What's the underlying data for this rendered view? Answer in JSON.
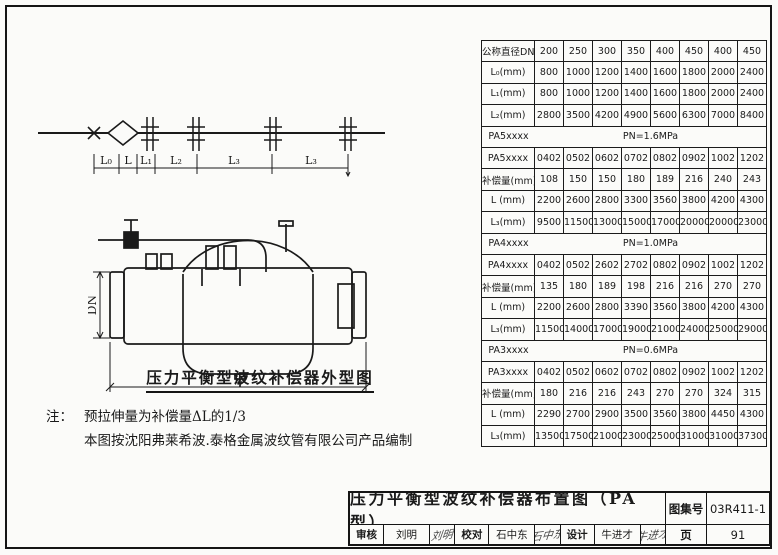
{
  "schematic": {
    "dimension_labels": [
      "L₀",
      "L",
      "L₁",
      "L₂",
      "L₃",
      "L₃"
    ]
  },
  "drawing": {
    "dn_label": "DN",
    "l_label": "L",
    "caption": "压力平衡型波纹补偿器外型图"
  },
  "notes": {
    "prefix": "注：",
    "line1": "预拉伸量为补偿量ΔL的1/3",
    "line2": "本图按沈阳弗莱希波.泰格金属波纹管有限公司产品编制"
  },
  "spec_table": {
    "rows": [
      {
        "label": "公称直径DN",
        "values": [
          "200",
          "250",
          "300",
          "350",
          "400",
          "450",
          "400",
          "450"
        ]
      },
      {
        "label": "L₀(mm)",
        "values": [
          "800",
          "1000",
          "1200",
          "1400",
          "1600",
          "1800",
          "2000",
          "2400"
        ]
      },
      {
        "label": "L₁(mm)",
        "values": [
          "800",
          "1000",
          "1200",
          "1400",
          "1600",
          "1800",
          "2000",
          "2400"
        ]
      },
      {
        "label": "L₂(mm)",
        "values": [
          "2800",
          "3500",
          "4200",
          "4900",
          "5600",
          "6300",
          "7000",
          "8400"
        ]
      },
      {
        "label": "PA5xxxx",
        "span": "PN=1.6MPa"
      },
      {
        "label": "PA5xxxx",
        "values": [
          "0402",
          "0502",
          "0602",
          "0702",
          "0802",
          "0902",
          "1002",
          "1202"
        ]
      },
      {
        "label": "补偿量(mm)",
        "values": [
          "108",
          "150",
          "150",
          "180",
          "189",
          "216",
          "240",
          "243"
        ]
      },
      {
        "label": "L (mm)",
        "values": [
          "2200",
          "2600",
          "2800",
          "3300",
          "3560",
          "3800",
          "4200",
          "4300"
        ]
      },
      {
        "label": "L₃(mm)",
        "values": [
          "9500",
          "11500",
          "13000",
          "15000",
          "17000",
          "20000",
          "20000",
          "23000"
        ]
      },
      {
        "label": "PA4xxxx",
        "span": "PN=1.0MPa"
      },
      {
        "label": "PA4xxxx",
        "values": [
          "0402",
          "0502",
          "2602",
          "2702",
          "0802",
          "0902",
          "1002",
          "1202"
        ]
      },
      {
        "label": "补偿量(mm)",
        "values": [
          "135",
          "180",
          "189",
          "198",
          "216",
          "216",
          "270",
          "270"
        ]
      },
      {
        "label": "L (mm)",
        "values": [
          "2200",
          "2600",
          "2800",
          "3390",
          "3560",
          "3800",
          "4200",
          "4300"
        ]
      },
      {
        "label": "L₃(mm)",
        "values": [
          "11500",
          "14000",
          "17000",
          "19000",
          "21000",
          "24000",
          "25000",
          "29000"
        ]
      },
      {
        "label": "PA3xxxx",
        "span": "PN=0.6MPa"
      },
      {
        "label": "PA3xxxx",
        "values": [
          "0402",
          "0502",
          "0602",
          "0702",
          "0802",
          "0902",
          "1002",
          "1202"
        ]
      },
      {
        "label": "补偿量(mm)",
        "values": [
          "180",
          "216",
          "216",
          "243",
          "270",
          "270",
          "324",
          "315"
        ]
      },
      {
        "label": "L (mm)",
        "values": [
          "2290",
          "2700",
          "2900",
          "3500",
          "3560",
          "3800",
          "4450",
          "4300"
        ]
      },
      {
        "label": "L₃(mm)",
        "values": [
          "13500",
          "17500",
          "21000",
          "23000",
          "25000",
          "31000",
          "31000",
          "37300"
        ]
      }
    ]
  },
  "title_block": {
    "title": "压力平衡型波纹补偿器布置图（PA型）",
    "atlas_label": "图集号",
    "atlas_number": "03R411-1",
    "page_label": "页",
    "page_number": "91",
    "roles": [
      {
        "role": "审核",
        "name": "刘明",
        "signature": "刘明"
      },
      {
        "role": "校对",
        "name": "石中东",
        "signature": "石中东"
      },
      {
        "role": "设计",
        "name": "牛进才",
        "signature": "牛进才"
      }
    ]
  }
}
